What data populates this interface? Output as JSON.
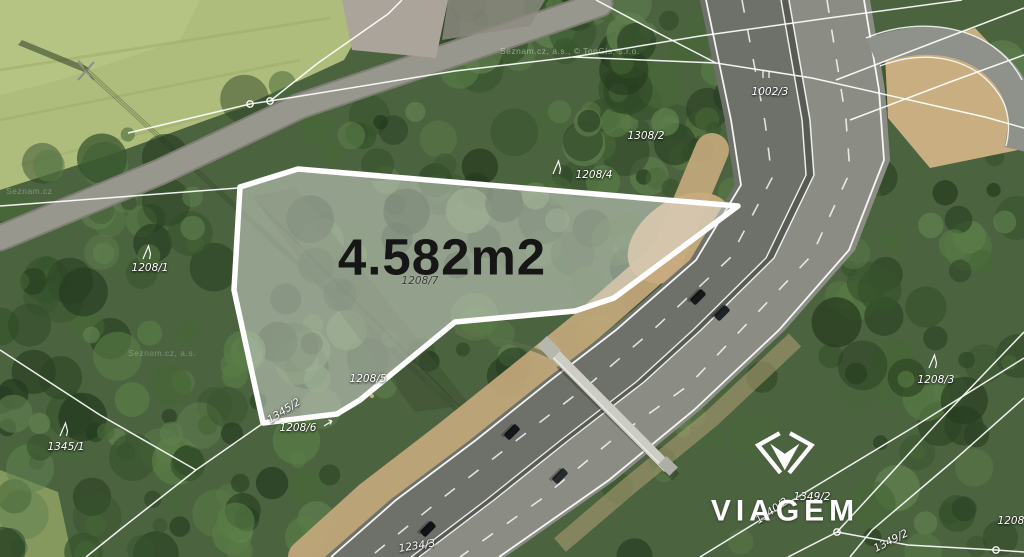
{
  "branding": {
    "name": "VIAGEM"
  },
  "watermarks": {
    "top": "Seznam.cz, a.s., © TopGis, s.r.o.",
    "left": "Seznam.cz",
    "mid": "Seznam.cz, a.s."
  },
  "parcel": {
    "area_label": "4.582m2",
    "number": "1208/7",
    "outline": [
      [
        240,
        187
      ],
      [
        298,
        169
      ],
      [
        738,
        206
      ],
      [
        614,
        298
      ],
      [
        575,
        311
      ],
      [
        455,
        322
      ],
      [
        360,
        400
      ],
      [
        337,
        414
      ],
      [
        263,
        423
      ],
      [
        234,
        290
      ]
    ],
    "fill": "rgba(225,228,224,0.48)",
    "stroke": "#ffffff",
    "stroke_width": 5.5
  },
  "map": {
    "colors": {
      "boundary": "#ffffff",
      "cadastral_line": "#ffffff",
      "label": "#ffffff",
      "label_dark": "#3a403b",
      "area_text": "#161616",
      "logo": "#ffffff"
    }
  },
  "cadastral": {
    "lines": [
      [
        [
          0,
          206
        ],
        [
          238,
          188
        ]
      ],
      [
        [
          128,
          133
        ],
        [
          250,
          104
        ],
        [
          270,
          101
        ],
        [
          455,
          71
        ],
        [
          573,
          57
        ],
        [
          700,
          36
        ],
        [
          836,
          17
        ],
        [
          962,
          0
        ]
      ],
      [
        [
          270,
          101
        ],
        [
          318,
          63
        ],
        [
          388,
          14
        ],
        [
          402,
          0
        ]
      ],
      [
        [
          573,
          57
        ],
        [
          716,
          63
        ],
        [
          812,
          78
        ],
        [
          985,
          117
        ],
        [
          1024,
          128
        ]
      ],
      [
        [
          596,
          0
        ],
        [
          660,
          34
        ],
        [
          716,
          63
        ]
      ],
      [
        [
          836,
          80
        ],
        [
          940,
          40
        ],
        [
          1024,
          8
        ]
      ],
      [
        [
          850,
          120
        ],
        [
          950,
          82
        ],
        [
          1024,
          55
        ]
      ],
      [
        [
          1024,
          332
        ],
        [
          938,
          422
        ],
        [
          837,
          532
        ],
        [
          788,
          557
        ]
      ],
      [
        [
          1024,
          398
        ],
        [
          952,
          462
        ],
        [
          872,
          530
        ],
        [
          850,
          557
        ]
      ],
      [
        [
          837,
          532
        ],
        [
          908,
          545
        ],
        [
          996,
          550
        ],
        [
          1024,
          552
        ]
      ],
      [
        [
          700,
          557
        ],
        [
          806,
          492
        ],
        [
          912,
          428
        ],
        [
          1024,
          358
        ]
      ],
      [
        [
          262,
          424
        ],
        [
          196,
          470
        ],
        [
          122,
          528
        ],
        [
          86,
          557
        ]
      ],
      [
        [
          0,
          350
        ],
        [
          100,
          415
        ],
        [
          196,
          470
        ]
      ]
    ],
    "circles": [
      [
        250,
        104
      ],
      [
        270,
        101
      ],
      [
        837,
        532
      ],
      [
        996,
        550
      ]
    ],
    "labels": [
      {
        "text": "1002/3",
        "x": 770,
        "y": 92,
        "rot": 0,
        "symbol": "meadow",
        "sx": 762,
        "sy": 71
      },
      {
        "text": "1308/2",
        "x": 646,
        "y": 136,
        "rot": 0
      },
      {
        "text": "1208/4",
        "x": 594,
        "y": 175,
        "rot": 0,
        "symbol": "tree",
        "sx": 553,
        "sy": 161
      },
      {
        "text": "1208/1",
        "x": 150,
        "y": 268,
        "rot": 0,
        "symbol": "tree",
        "sx": 143,
        "sy": 246
      },
      {
        "text": "1208/7",
        "x": 420,
        "y": 281,
        "rot": 0,
        "dark": true
      },
      {
        "text": "1208/5",
        "x": 368,
        "y": 379,
        "rot": 0
      },
      {
        "text": "1345/2",
        "x": 284,
        "y": 411,
        "rot": -33
      },
      {
        "text": "1208/6",
        "x": 298,
        "y": 428,
        "rot": 0,
        "symbol": "arrow",
        "sx": 324,
        "sy": 419
      },
      {
        "text": "1345/1",
        "x": 66,
        "y": 447,
        "rot": 0,
        "symbol": "tree",
        "sx": 60,
        "sy": 423
      },
      {
        "text": "1208/3",
        "x": 936,
        "y": 380,
        "rot": 0,
        "symbol": "tree",
        "sx": 929,
        "sy": 355
      },
      {
        "text": "1234/3",
        "x": 417,
        "y": 546,
        "rot": -9
      },
      {
        "text": "1349/2",
        "x": 812,
        "y": 497,
        "rot": 0
      },
      {
        "text": "1340/2",
        "x": 772,
        "y": 511,
        "rot": -35
      },
      {
        "text": "1349/2",
        "x": 891,
        "y": 541,
        "rot": -27
      },
      {
        "text": "1208/2",
        "x": 1016,
        "y": 521,
        "rot": 0
      }
    ]
  }
}
